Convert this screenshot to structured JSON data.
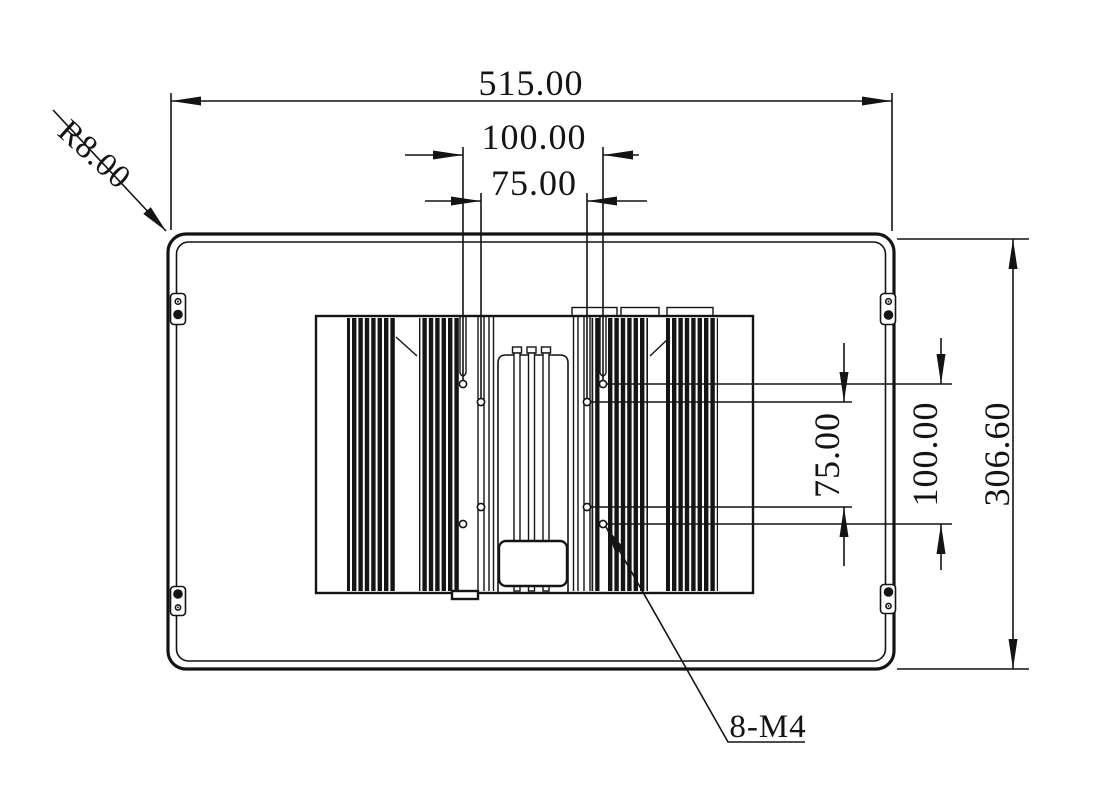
{
  "drawing": {
    "title": "panel-pc-rear-dimension-drawing",
    "colors": {
      "line": "#141414",
      "background": "#ffffff"
    },
    "dimensions": {
      "overall_width": "515.00",
      "vesa_width_100": "100.00",
      "vesa_width_75": "75.00",
      "overall_height": "306.60",
      "vesa_height_100": "100.00",
      "vesa_height_75": "75.00",
      "corner_radius": "R8.00",
      "thread_callout": "8-M4"
    }
  }
}
